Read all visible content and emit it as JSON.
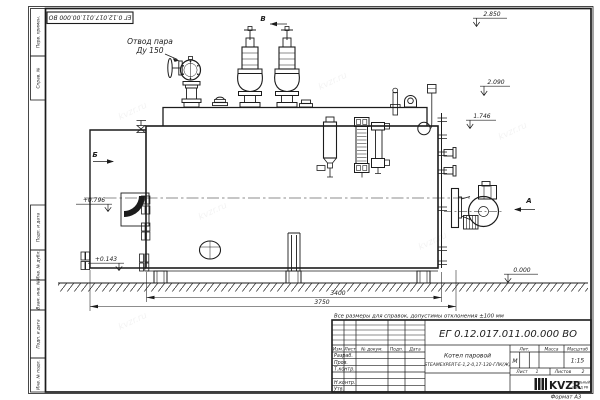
{
  "page": {
    "format_label": "Формат А3",
    "watermark": "kvzr.ru"
  },
  "top_stamp": {
    "doc_number": "ЕГ 0.12.017.011.00.000  ВО"
  },
  "callouts": {
    "steam_outlet_line1": "Отвод пара",
    "steam_outlet_line2": "Ду 150"
  },
  "view_labels": {
    "top": "В",
    "left": "Б",
    "right": "А"
  },
  "elevations": {
    "valve_top": "2.850",
    "boiler_top": "2.090",
    "gauge_top": "1.746",
    "front_upper": "+0.796",
    "front_lower": "+0.143",
    "ground": "0.000"
  },
  "dimensions": {
    "shell_length": "3400",
    "overall_length": "3750"
  },
  "note": "Все размеры для справок, допустимы отклонения ±100 мм",
  "title_block": {
    "doc_number": "ЕГ 0.12.017.011.00.000  ВО",
    "product_line1": "Котел паровой",
    "product_line2": "STEAMEXPERT-Е-1,2-0,17-130-ГЛК(Ж)",
    "columns": {
      "izm": "Изм.",
      "list": "Лист",
      "doc": "№ докум.",
      "podp": "Подп.",
      "data": "Дата"
    },
    "rows": [
      "Разраб.",
      "Пров.",
      "Т.контр.",
      "Н.контр.",
      "Утв."
    ],
    "lit_label": "Лит.",
    "lit_value": "М",
    "mass_label": "Масса",
    "scale_label": "Масштаб",
    "scale_value": "1:15",
    "sheet_label": "Лист",
    "sheet_value": "1",
    "sheets_label": "Листов",
    "sheets_value": "2",
    "logo_text": "KVZR",
    "logo_sub1": "КОТЕЛЬНЫЙ",
    "logo_sub2": "ЗАВОД РФ"
  },
  "side_stamps": [
    "Перв. примен.",
    "Справ. №",
    "Подп. и дата",
    "Инв. № дубл.",
    "Взам. инв. №",
    "Подп. и дата",
    "Инв. № подл."
  ]
}
